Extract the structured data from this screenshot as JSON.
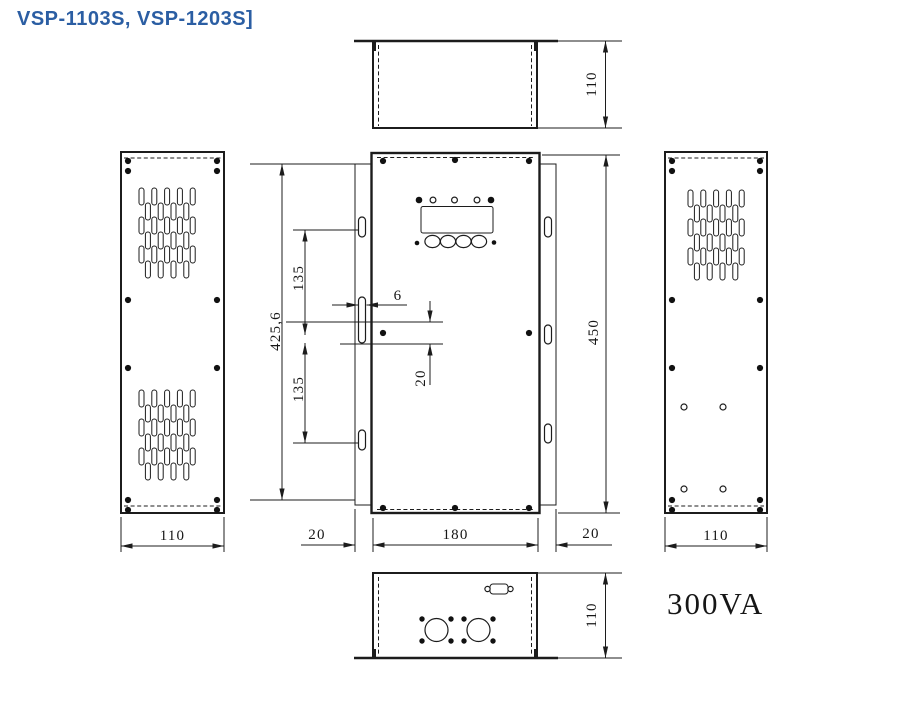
{
  "title": "VSP-1103S, VSP-1203S]",
  "power_rating": "300VA",
  "colors": {
    "line": "#1c1c1c",
    "title": "#2b5ea3",
    "background": "#ffffff"
  },
  "dims": {
    "top_depth": "110",
    "left_width": "110",
    "right_width": "110",
    "bottom_depth": "110",
    "bracket_height": "425,6",
    "upper_hole_spacing": "135",
    "lower_hole_spacing": "135",
    "slot_width": "6",
    "slot_height": "20",
    "panel_height": "450",
    "left_flange": "20",
    "panel_width": "180",
    "right_flange": "20"
  }
}
